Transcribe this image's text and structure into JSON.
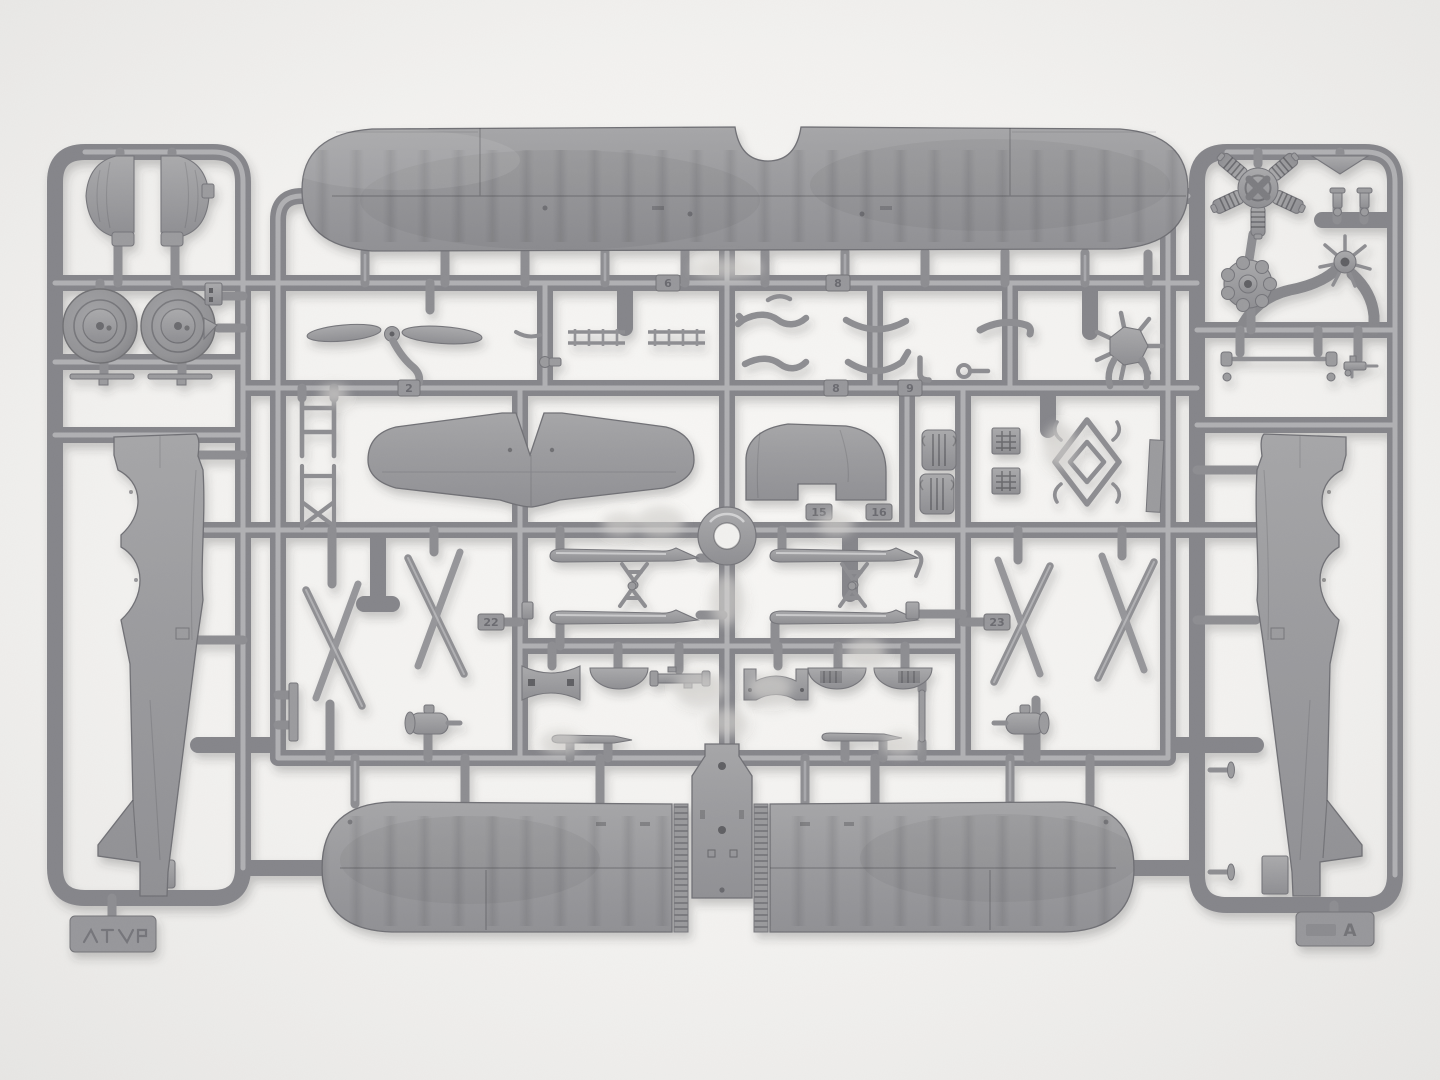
{
  "scene": {
    "type": "photograph",
    "subject": "Top-down studio photo of a gray injection-molded polystyrene sprue (parts frame) for a biplane model aircraft kit on a white background",
    "lighting": "soft even light, slight corner vignette",
    "background_color": "#f3f2f0",
    "plastic_color": "#97979a",
    "plastic_highlight": "#b7b7ba",
    "plastic_shadow": "#6d6d70"
  },
  "sprue": {
    "sprue_letter": "A",
    "part_number_tags": [
      "2",
      "6",
      "8",
      "9",
      "15",
      "16",
      "22",
      "23"
    ],
    "parts": [
      "upper wing (one-piece with centre cut-out)",
      "lower wing half x2",
      "fuselage half left",
      "fuselage half right",
      "fuselage belly panel",
      "engine cowling half x2",
      "main wheel x2",
      "two-blade propeller",
      "horizontal stabiliser",
      "vertical fin",
      "five-cylinder radial engine",
      "engine crankcase",
      "engine front hub",
      "intake manifold spider",
      "exhaust pipe set",
      "ladder strip x2",
      "cabane strut frame x2",
      "interplane N-strut x4",
      "landing ski x4",
      "ski support triangle x4",
      "pilot seat x2",
      "radiator block x2",
      "welded-tube frame",
      "fuselage bulkhead former x6",
      "fuel pump x2",
      "tail ski x2",
      "pushrod bar",
      "small fittings and control horns"
    ]
  }
}
